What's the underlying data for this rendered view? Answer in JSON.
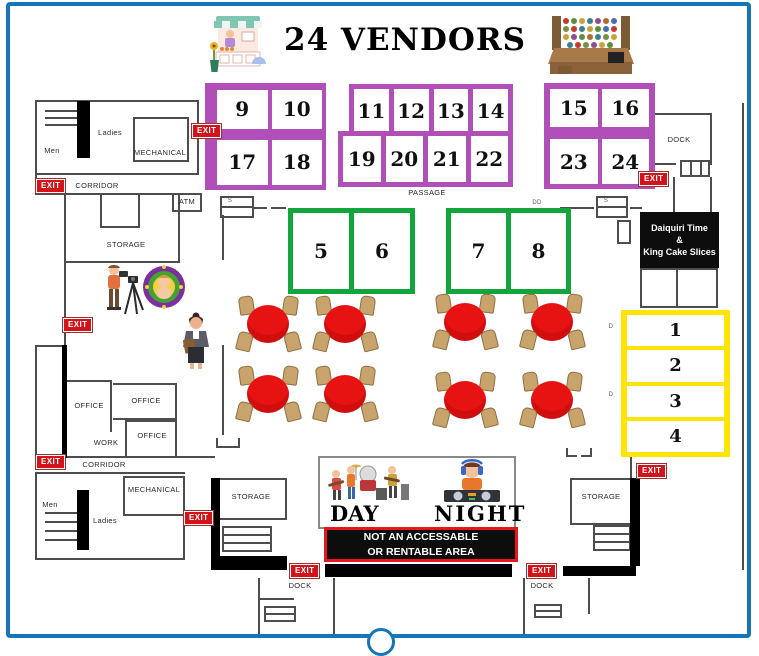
{
  "header": {
    "title": "24 VENDORS"
  },
  "booths": {
    "b1": "1",
    "b2": "2",
    "b3": "3",
    "b4": "4",
    "b5": "5",
    "b6": "6",
    "b7": "7",
    "b8": "8",
    "b9": "9",
    "b10": "10",
    "b11": "11",
    "b12": "12",
    "b13": "13",
    "b14": "14",
    "b15": "15",
    "b16": "16",
    "b17": "17",
    "b18": "18",
    "b19": "19",
    "b20": "20",
    "b21": "21",
    "b22": "22",
    "b23": "23",
    "b24": "24"
  },
  "labels": {
    "exit": "EXIT",
    "storage": "STORAGE",
    "corridor": "CORRIDOR",
    "mechanical": "MECHANICAL",
    "men": "Men",
    "ladies": "Ladies",
    "office": "OFFICE",
    "work": "WORK",
    "dock": "DOCK",
    "atm": "ATM",
    "passage": "PASSAGE",
    "s": "S",
    "dd": "DD",
    "d": "D"
  },
  "signs": {
    "daiquiri": {
      "l1": "Daiquiri Time",
      "l2": "&",
      "l3": "King Cake Slices"
    },
    "banner": {
      "l1": "NOT AN ACCESSABLE",
      "l2": "OR RENTABLE AREA"
    },
    "day": "DAY",
    "night": "NIGHT"
  },
  "floor": {
    "tables": [
      {
        "x": 236,
        "y": 296
      },
      {
        "x": 313,
        "y": 296
      },
      {
        "x": 433,
        "y": 294
      },
      {
        "x": 520,
        "y": 294
      },
      {
        "x": 236,
        "y": 366
      },
      {
        "x": 313,
        "y": 366
      },
      {
        "x": 433,
        "y": 372
      },
      {
        "x": 520,
        "y": 372
      }
    ],
    "chairs_per_table": 4,
    "table_count": 8
  },
  "colors": {
    "booth_purple": "#b14fb8",
    "booth_green": "#12a53c",
    "booth_yellow": "#ffe405",
    "table_red": "#e71312",
    "chair_tan": "#c9a36c",
    "exit_red": "#d2131a",
    "border_blue": "#1475b8",
    "sign_black": "#0d0d0d",
    "banner_border_red": "#e8151b"
  },
  "icons": {
    "market_stall": "market-stall-illustration",
    "vendor_goods": "vendor-goods-table-illustration",
    "photographer": "photographer-illustration",
    "king_cake": "king-cake-baby-logo",
    "coordinator": "event-coordinator-illustration",
    "day_band": "live-band-illustration",
    "night_dj": "dj-illustration"
  }
}
